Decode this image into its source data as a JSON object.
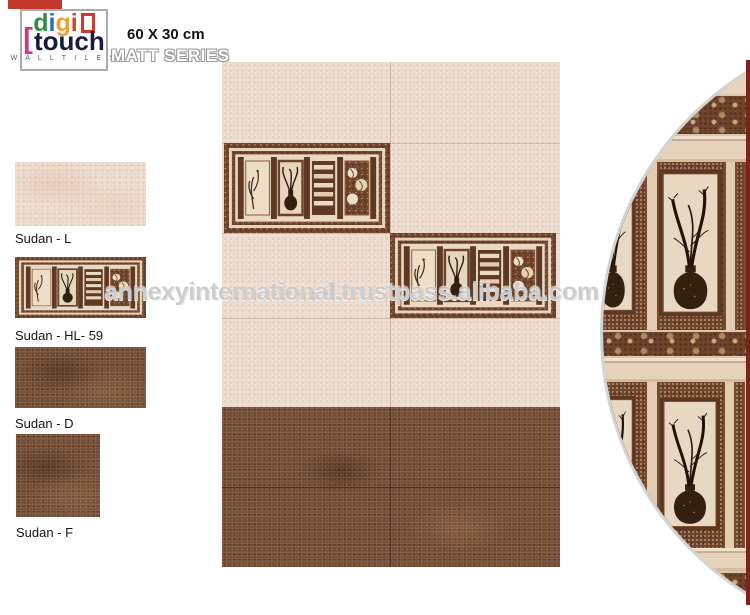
{
  "brand": {
    "letters": [
      {
        "char": "d",
        "color": "#2f8f3c"
      },
      {
        "char": "i",
        "color": "#2a6db8"
      },
      {
        "char": "g",
        "color": "#eda12f"
      },
      {
        "char": "i",
        "color": "#d2452f"
      }
    ],
    "bracket": "[",
    "word2": "touch",
    "tagline": "W A L L   T I L E S"
  },
  "header": {
    "size_label": "60 X 30 cm",
    "series_label": "MATT SERIES"
  },
  "sidebar": {
    "swatches": [
      {
        "label": "Sudan - L",
        "type": "plain-light-tile"
      },
      {
        "label": "Sudan - HL- 59",
        "type": "highlight-decor-tile"
      },
      {
        "label": "Sudan - D",
        "type": "plain-dark-tile"
      },
      {
        "label": "Sudan - F",
        "type": "plain-dark-floor-tile"
      }
    ]
  },
  "watermark": {
    "text": "annexyinternational.trustpass.alibaba.com"
  },
  "palette": {
    "accent_red": "#c0392b",
    "brand_green": "#2f8f3c",
    "brand_blue": "#2a6db8",
    "brand_orange": "#eda12f",
    "brand_crimson": "#d2452f",
    "brand_magenta": "#d5357f",
    "wall_light": "#ecdacd",
    "wall_dark": "#6e4a33",
    "decor_brown": "#6e452c",
    "frame_beige": "#e5d2ba",
    "edge_maroon": "#7c241c",
    "ring_gray": "#d3d3d3"
  }
}
